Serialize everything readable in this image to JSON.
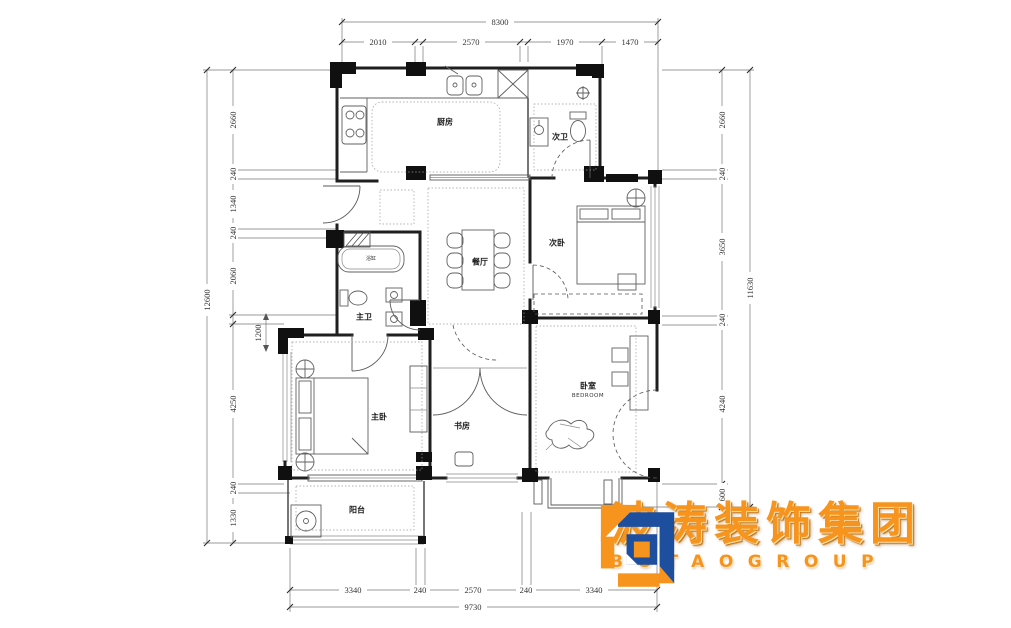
{
  "rooms": {
    "kitchen": "厨房",
    "second_bath": "次卫",
    "second_bedroom": "次卧",
    "dining": "餐厅",
    "master_bath": "主卫",
    "bathtub": "浴缸",
    "master_bedroom": "主卧",
    "study": "书房",
    "bedroom": "卧室",
    "bedroom_en": "BEDROOM",
    "balcony": "阳台"
  },
  "dimensions": {
    "top": {
      "overall": "8300",
      "segments": [
        "2010",
        "2570",
        "1970",
        "1470"
      ]
    },
    "left": {
      "overall": "12600",
      "segments": [
        "2660",
        "240",
        "1340",
        "240",
        "2060",
        "4250",
        "240",
        "1330"
      ],
      "floating": "1200"
    },
    "right": {
      "overall": "11630",
      "segments": [
        "2660",
        "240",
        "3650",
        "240",
        "4240",
        "600"
      ]
    },
    "bottom": {
      "overall": "9730",
      "segments": [
        "3340",
        "240",
        "2570",
        "240",
        "3340"
      ]
    }
  },
  "logo": {
    "cn": "波涛装饰集团",
    "en": "BOTAOGROUP",
    "orange": "#F7941D",
    "blue": "#1E4F9E"
  }
}
